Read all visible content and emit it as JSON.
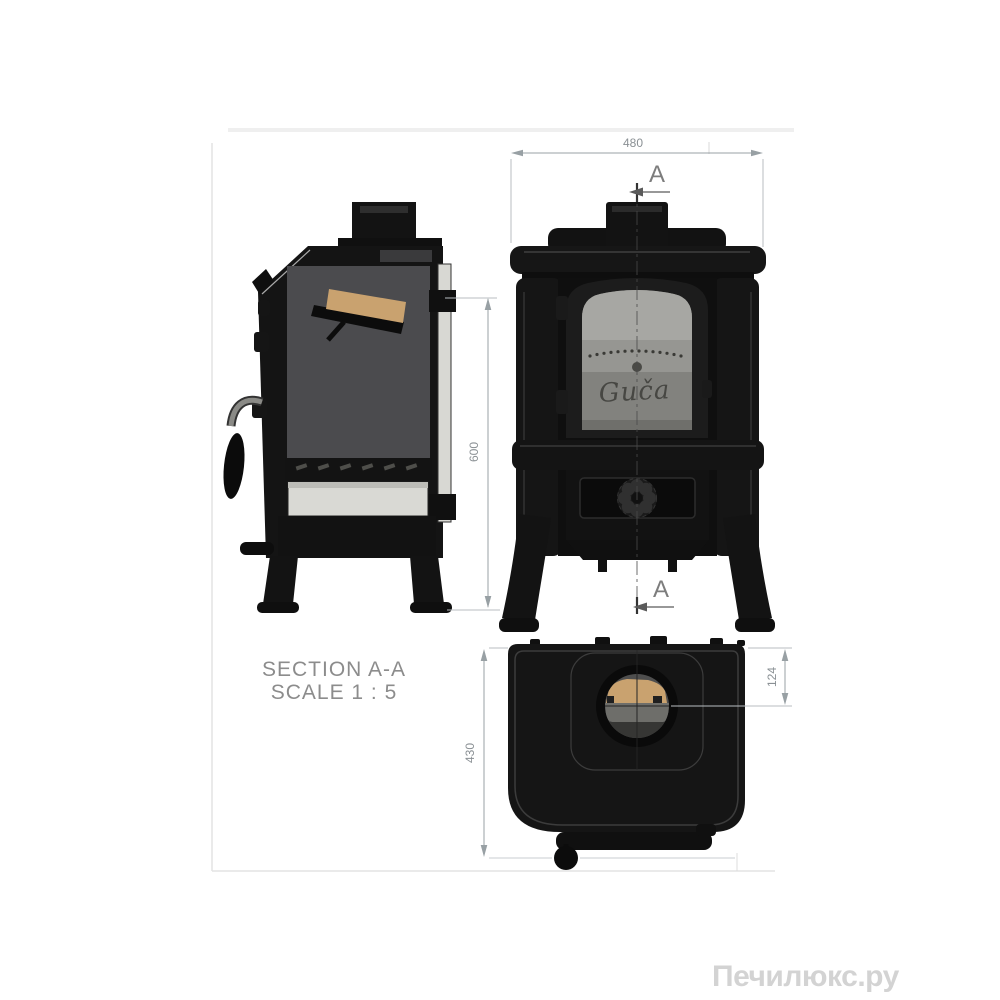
{
  "watermark": {
    "text": "Печилюкс.ру",
    "color": "#d3d3d3"
  },
  "drawing": {
    "title_block": {
      "section_title": "SECTION A-A",
      "scale": "SCALE 1 : 5"
    },
    "section_marker": {
      "top": "A",
      "bottom": "A"
    },
    "dimensions": {
      "front_width_mm": "480",
      "front_height_mm": "600",
      "top_depth_mm": "430",
      "flue_offset_mm": "124"
    },
    "logo_script": "Guča",
    "colors": {
      "stove_black": "#141414",
      "firebox_gray": "#4b4b4e",
      "baffle_tan": "#c9a26f",
      "ash_pan": "#d9d9d4",
      "glass_pane": "#858581",
      "glass_strip": "#d8d8d3",
      "dim_line": "#98a0a4",
      "dim_text": "#8a9094",
      "label_text": "#8c8c8c",
      "frame_line": "#e3e3e3"
    }
  }
}
